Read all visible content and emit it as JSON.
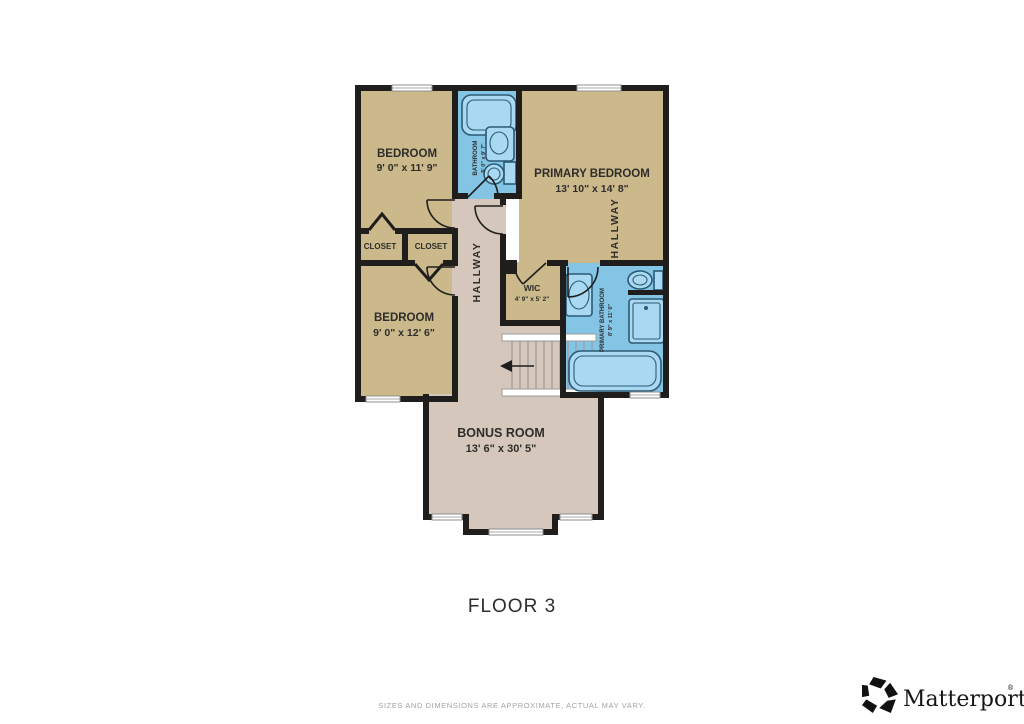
{
  "floor_plan": {
    "title": "FLOOR 3",
    "disclaimer": "SIZES AND DIMENSIONS ARE APPROXIMATE, ACTUAL MAY VARY.",
    "rooms": {
      "bedroom_top": {
        "label": "BEDROOM",
        "dims": "9' 0\" x 11' 9\""
      },
      "bathroom": {
        "label": "BATHROOM",
        "dims": "5' 0\" x 9' 7\""
      },
      "primary_bedroom": {
        "label": "PRIMARY BEDROOM",
        "dims": "13' 10\" x 14' 8\""
      },
      "hallway_upper": {
        "label": "HALLWAY"
      },
      "closet_left": {
        "label": "CLOSET"
      },
      "closet_right": {
        "label": "CLOSET"
      },
      "bedroom_bottom": {
        "label": "BEDROOM",
        "dims": "9' 0\" x 12' 6\""
      },
      "hallway_center": {
        "label": "HALLWAY"
      },
      "wic": {
        "label": "WIC",
        "dims": "4' 9\" x 5' 2\""
      },
      "primary_bathroom": {
        "label": "PRIMARY BATHROOM",
        "dims": "8' 9\" x 11' 0\""
      },
      "bonus_room": {
        "label": "BONUS ROOM",
        "dims": "13' 6\" x 30' 5\""
      }
    },
    "colors": {
      "room_fill": "#cbb98c",
      "hall_fill": "#d5c7bb",
      "bath_fill": "#84c5e6",
      "fixture_fill": "#a9d9f2",
      "wall": "#1f1e1c",
      "window": "#ffffff",
      "label": "#2e2d2a",
      "disclaimer_text": "#a3a3a3",
      "logo": "#111111"
    }
  },
  "branding": {
    "name": "Matterport",
    "trademark": "®"
  }
}
